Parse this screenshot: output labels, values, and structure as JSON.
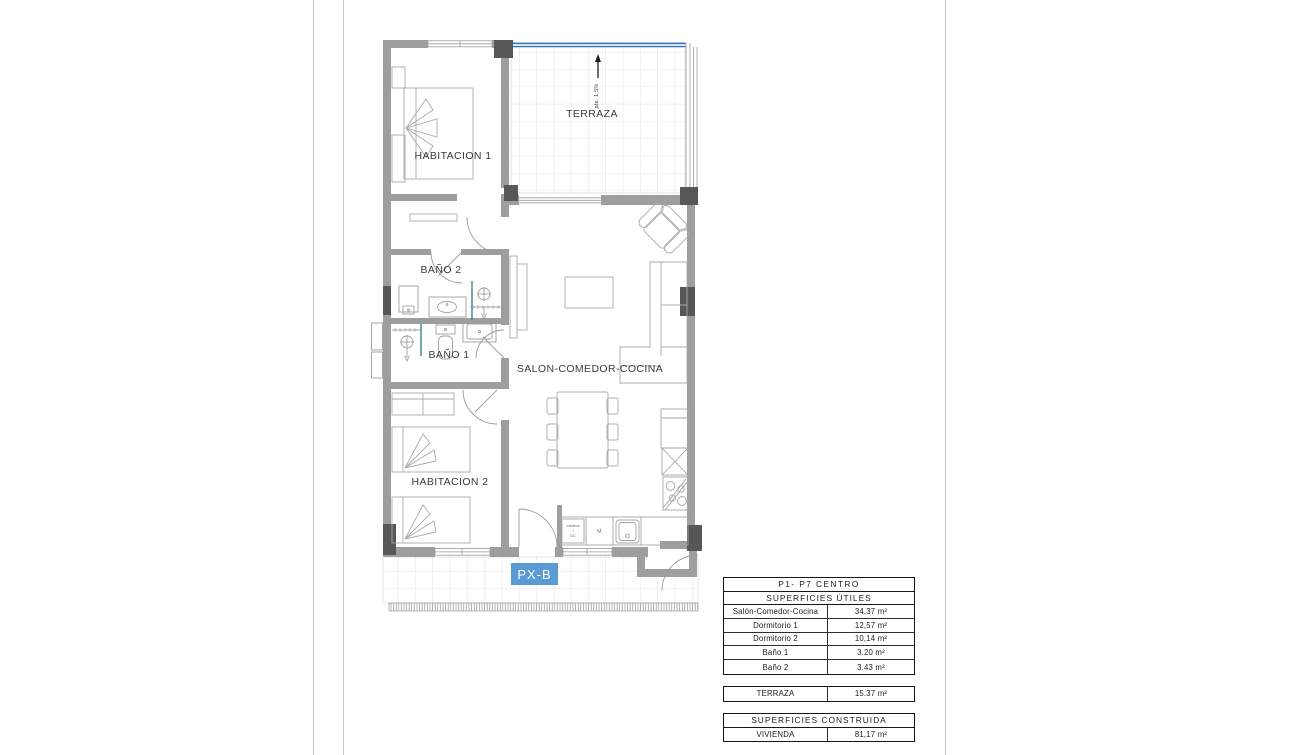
{
  "plan": {
    "labels": {
      "habitacion1": "HABITACION 1",
      "habitacion2": "HABITACION 2",
      "bano1": "BAÑO 1",
      "bano2": "BAÑO 2",
      "salon": "SALON-COMEDOR-COCINA",
      "terraza": "TERRAZA",
      "slope": "pte. 1,5%",
      "px": "PX-B",
      "kitchen_unit_line1": "caldera",
      "kitchen_unit_line2": "+",
      "kitchen_unit_line3": "DC",
      "kitchen_unit2": "M."
    },
    "colors": {
      "wall": "#9e9e9e",
      "column": "#575757",
      "parapet_blue": "#2e75b6",
      "px_highlight": "#5b9bd5",
      "shower_glass": "#38868a",
      "tile_line": "#dcdcdc",
      "label_text": "#3a3a3a"
    }
  },
  "tables": {
    "utiles": {
      "title": "P1- P7 CENTRO",
      "subtitle": "SUPERFICIES ÚTILES",
      "rows": [
        {
          "label": "Salón-Comedor-Cocina",
          "value": "34,37 m²"
        },
        {
          "label": "Dormitorio 1",
          "value": "12,57 m²"
        },
        {
          "label": "Dormitorio 2",
          "value": "10,14 m²"
        },
        {
          "label": "Baño 1",
          "value": "3.20 m²"
        },
        {
          "label": "Baño 2",
          "value": "3.43 m²"
        }
      ]
    },
    "terraza_row": {
      "label": "TERRAZA",
      "value": "15.37 m²"
    },
    "construida": {
      "title": "SUPERFICIES CONSTRUIDA",
      "rows": [
        {
          "label": "VIVIENDA",
          "value": "81,17 m²"
        }
      ]
    }
  }
}
